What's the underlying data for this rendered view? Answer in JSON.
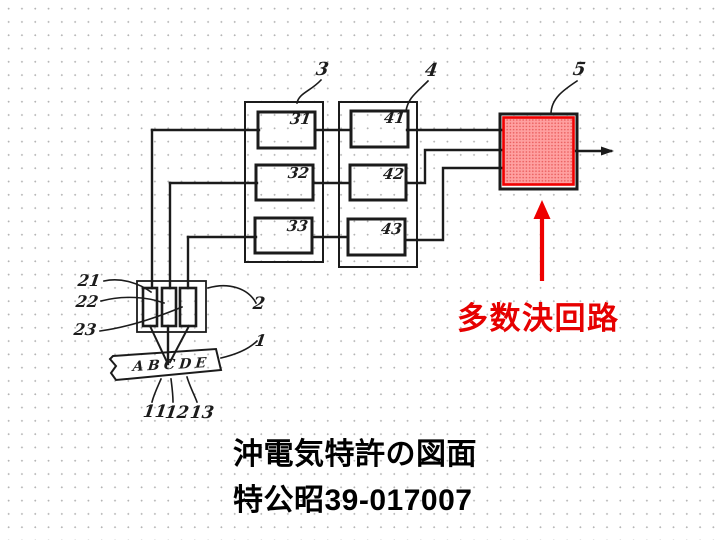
{
  "slide": {
    "annotation": {
      "label": "多数決回路"
    },
    "caption": {
      "line1": "沖電気特許の図面",
      "line2": "特公昭39-017007"
    }
  },
  "diagram": {
    "figure_labels": {
      "fig1": "1",
      "fig2": "2",
      "fig3": "3",
      "fig4": "4",
      "fig5": "5"
    },
    "box_labels": {
      "b31": "31",
      "b32": "32",
      "b33": "33",
      "b41": "41",
      "b42": "42",
      "b43": "43"
    },
    "sensor_labels": {
      "s21": "21",
      "s22": "22",
      "s23": "23"
    },
    "track_labels": {
      "t11": "11",
      "t12": "12",
      "t13": "13"
    },
    "tape_letters": "ABCDE"
  },
  "colors": {
    "line_black": "#1b1b1b",
    "highlight_border": "#f10000",
    "highlight_fill_base": "#ffa0a0",
    "highlight_fill_dot": "#ea6060",
    "annotation_red": "#e60000",
    "background_dot": "#b4b4b4"
  }
}
